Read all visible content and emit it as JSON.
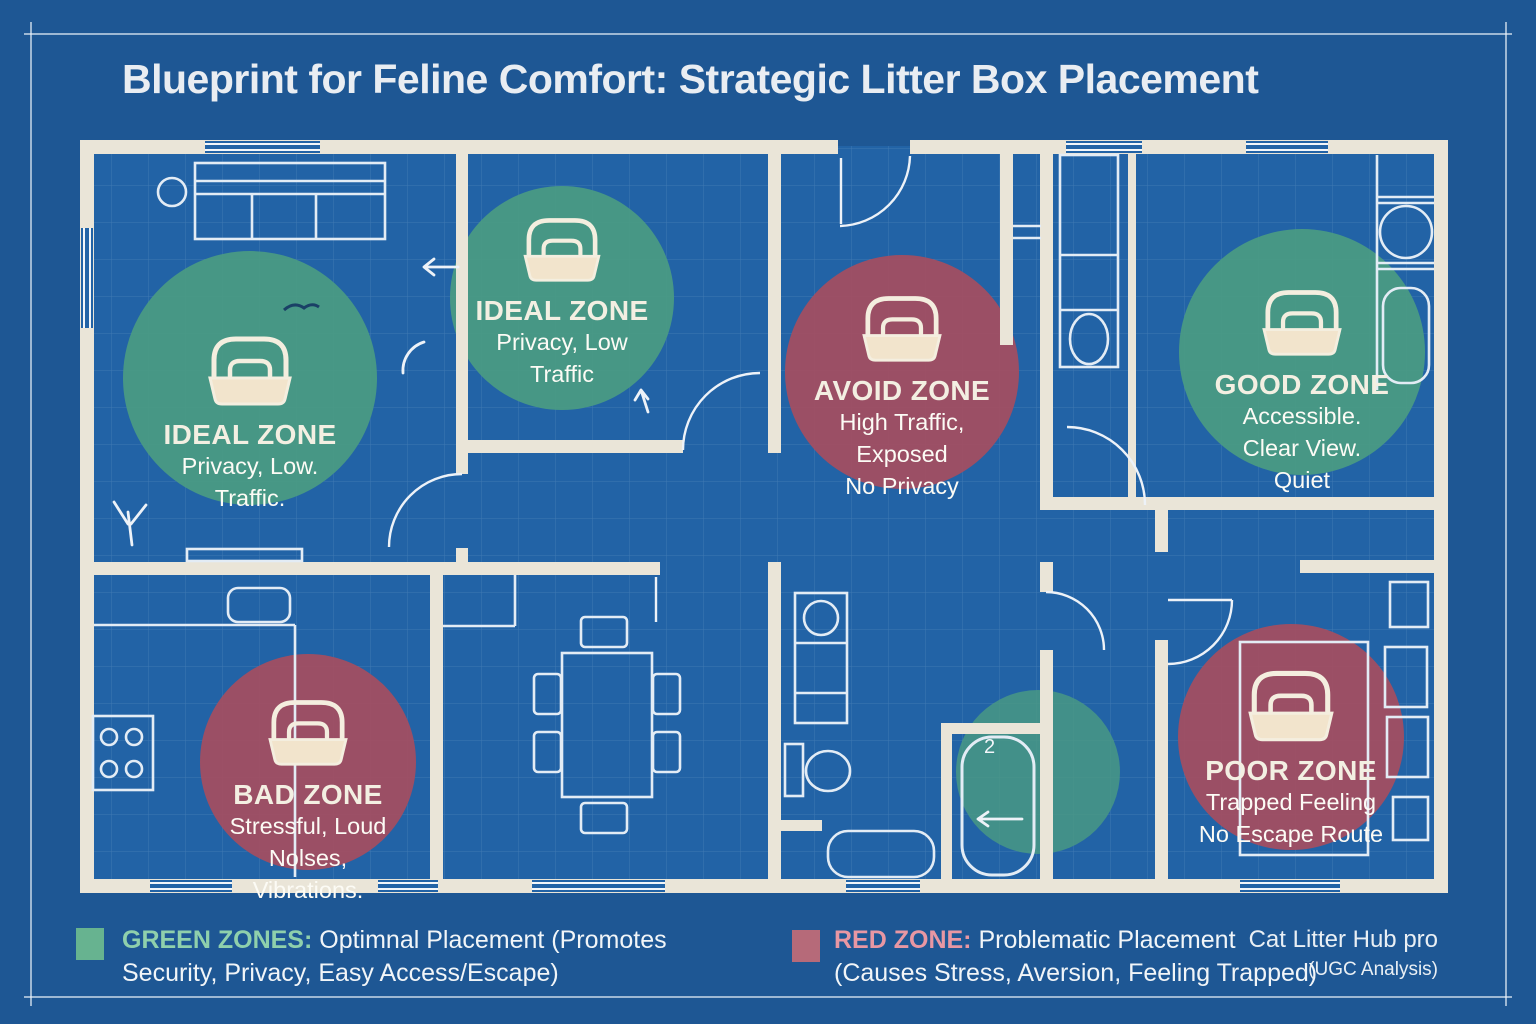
{
  "title": "Blueprint for Feline Comfort: Strategic Litter Box Placement",
  "zones": {
    "ideal1": {
      "title": "IDEAL ZONE",
      "l1": "Privacy, Low.",
      "l2": "Traffic."
    },
    "ideal2": {
      "title": "IDEAL ZONE",
      "l1": "Privacy, Low",
      "l2": "Traffic"
    },
    "avoid": {
      "title": "AVOID ZONE",
      "l1": "High Traffic,",
      "l2": "Exposed",
      "l3": "No Privacy"
    },
    "good": {
      "title": "GOOD ZONE",
      "l1": "Accessible.",
      "l2": "Clear View.",
      "l3": "Quiet"
    },
    "bad": {
      "title": "BAD ZONE",
      "l1": "Stressful, Loud",
      "l2": "Nolses,",
      "l3": "Vibrations."
    },
    "poor": {
      "title": "POOR ZONE",
      "l1": "Trapped Feeling",
      "l2": "No Escape Route"
    }
  },
  "legend": {
    "green": {
      "label": "GREEN ZONES:",
      "line1": "Optimnal Placement (Promotes",
      "line2": "Security, Privacy, Easy Access/Escape)"
    },
    "red": {
      "label": "RED ZONE:",
      "line1": "Problematic Placement",
      "line2": "(Causes Stress, Aversion, Feeling Trapped)"
    }
  },
  "attribution": {
    "line1": "Cat Litter Hub pro",
    "line2": "(UGC Analysis)"
  },
  "plan": {
    "shower_label": "2"
  },
  "colors": {
    "background": "#1E5794",
    "floor": "#2263A6",
    "wall": "#EAE5D8",
    "green_zone": "#4B9B82",
    "red_zone": "#A64D60",
    "litterbox_fill": "#F2E4CC",
    "legend_green_label": "#8FD0AC",
    "legend_red_label": "#E897A3"
  }
}
